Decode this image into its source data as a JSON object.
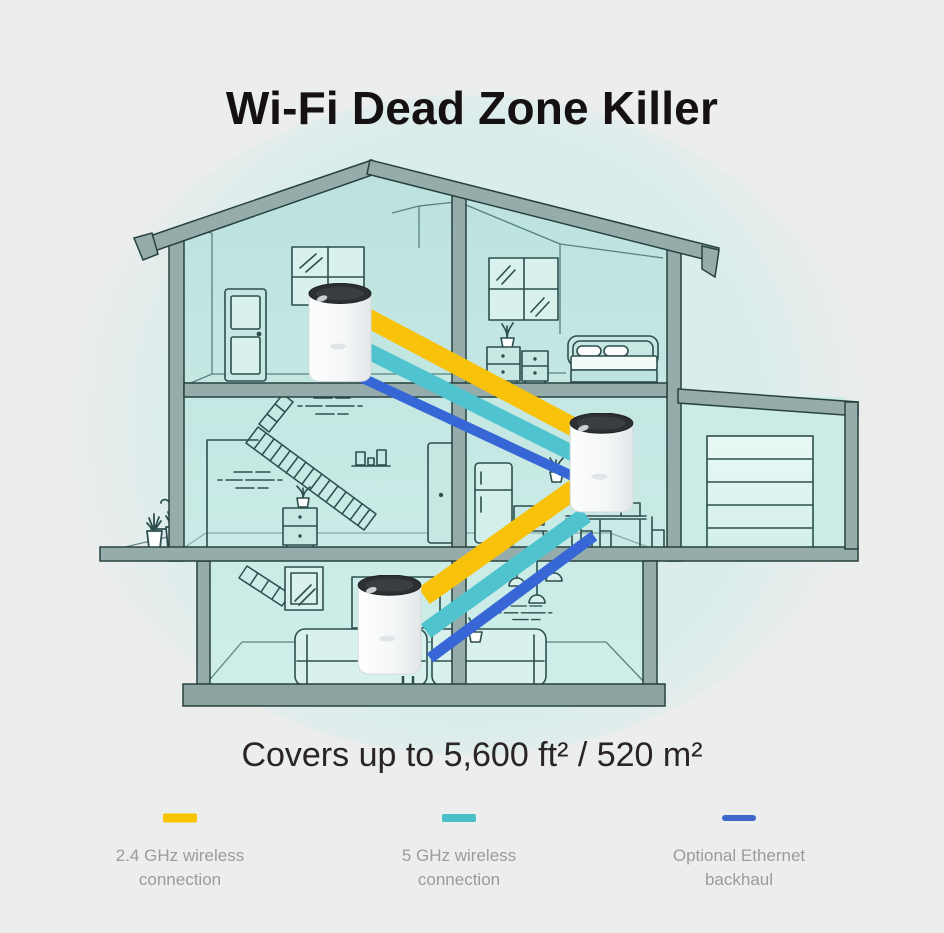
{
  "header": {
    "title": "Wi-Fi Dead Zone Killer"
  },
  "coverage": {
    "text": "Covers up to 5,600 ft² / 520 m²"
  },
  "legend": {
    "items": [
      {
        "label_line1": "2.4 GHz wireless",
        "label_line2": "connection",
        "color": "#F7C400"
      },
      {
        "label_line1": "5 GHz wireless",
        "label_line2": "connection",
        "color": "#4BC0C9"
      },
      {
        "label_line1": "Optional Ethernet",
        "label_line2": "backhaul",
        "color": "#3E68CC"
      }
    ]
  },
  "diagram": {
    "band_colors": {
      "wireless_24ghz": "#F9C20A",
      "wireless_5ghz": "#4FC3CE",
      "ethernet_backhaul": "#3767D6"
    },
    "house_colors": {
      "interior": "#C5E8E3",
      "beam": "#95ACAB",
      "line": "#2C4F4E",
      "background_glow": "#DAEDEB"
    },
    "devices": [
      "deco-unit-attic",
      "deco-unit-middle-floor",
      "deco-unit-living-room"
    ]
  }
}
